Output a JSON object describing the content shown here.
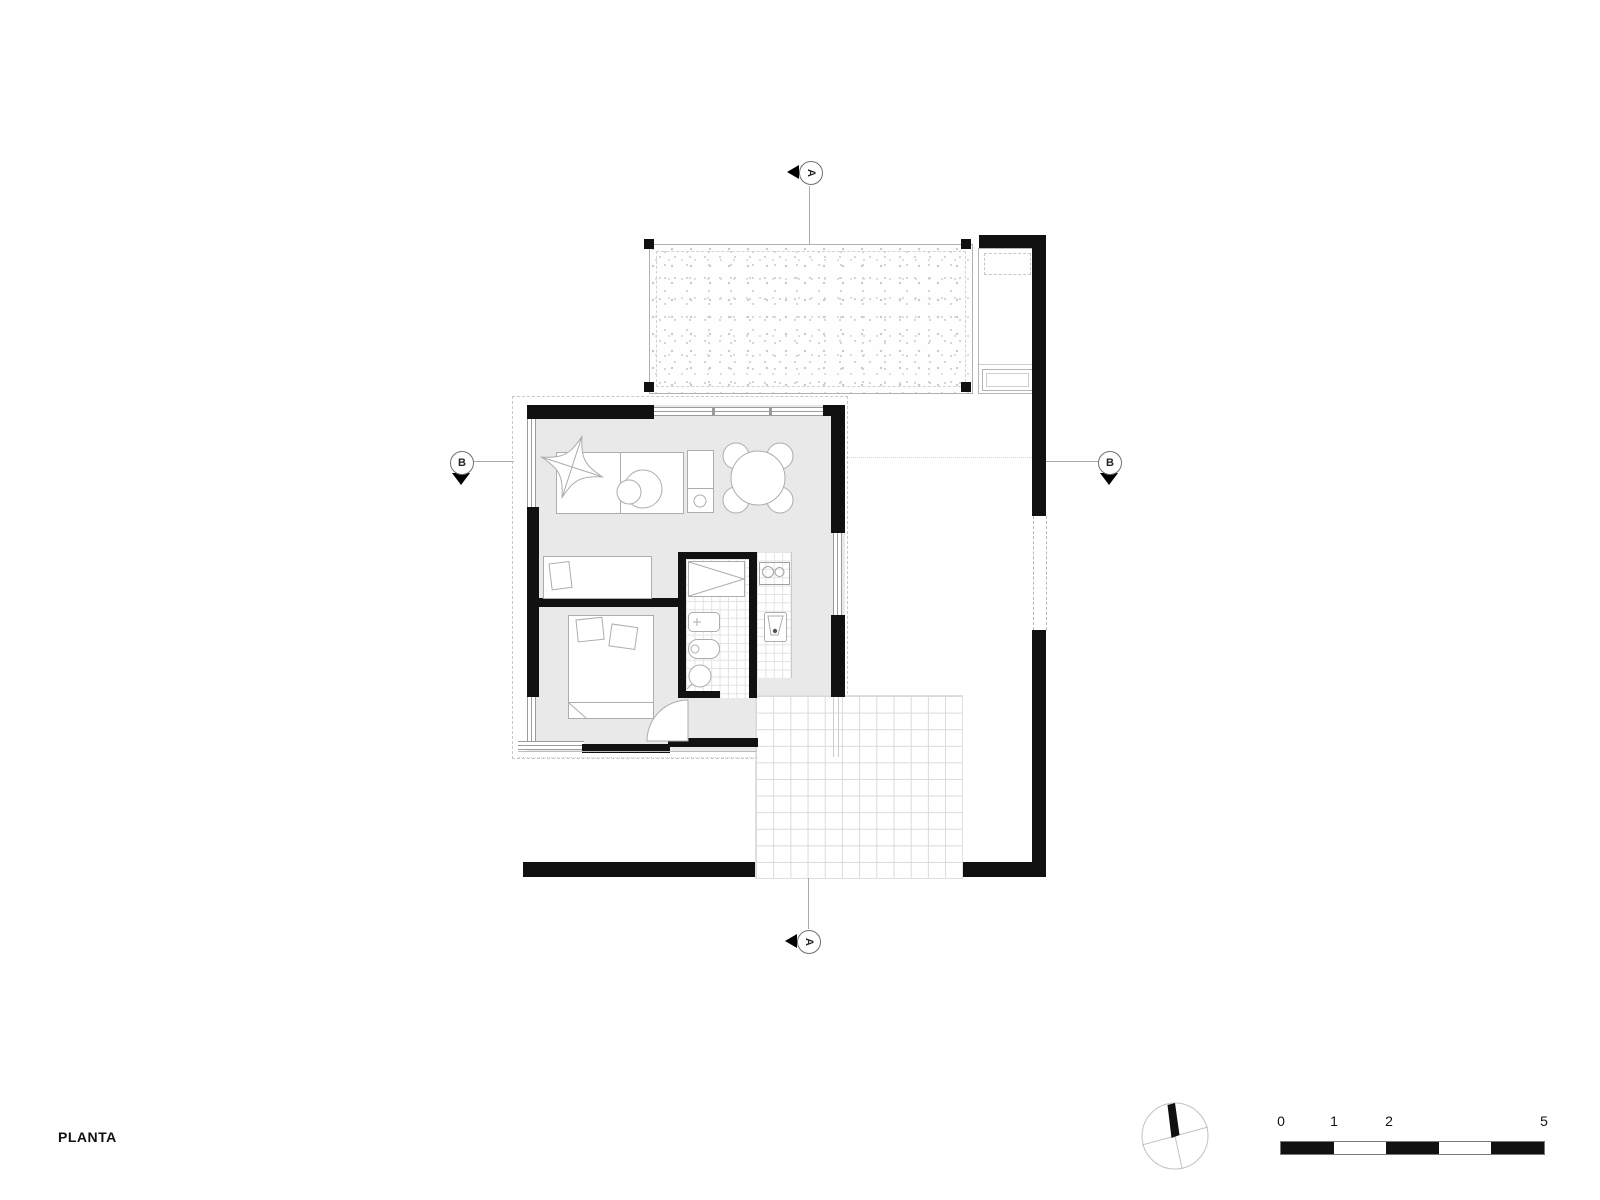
{
  "title": {
    "label": "PLANTA"
  },
  "section_markers": {
    "a_top": {
      "letter": "A"
    },
    "a_bottom": {
      "letter": "A"
    },
    "b_left": {
      "letter": "B"
    },
    "b_right": {
      "letter": "B"
    }
  },
  "scale_bar": {
    "tick_labels": [
      "0",
      "1",
      "2",
      "5"
    ]
  },
  "icons": {
    "north_arrow": "compass-circle-with-needle",
    "section_arrow": "filled-triangle-direction-marker"
  },
  "colors": {
    "wall": "#111111",
    "floor": "#e9e9e9",
    "outline": "#a8a8a8",
    "grid_line": "#dadada",
    "dashed": "#c8c8c8",
    "background": "#ffffff"
  },
  "plan_elements": [
    "stippled-deck",
    "annex-room",
    "boundary-walls",
    "sliding-gate",
    "living-dining-room",
    "dining-table",
    "sofa-rug",
    "butterfly-chair",
    "single-bed-room",
    "double-bed-room",
    "bathroom",
    "shower",
    "washbasin",
    "toilet",
    "kitchen-counter",
    "cooktop",
    "sink",
    "entry-door",
    "tiled-patio",
    "north-arrow",
    "scale-bar"
  ]
}
